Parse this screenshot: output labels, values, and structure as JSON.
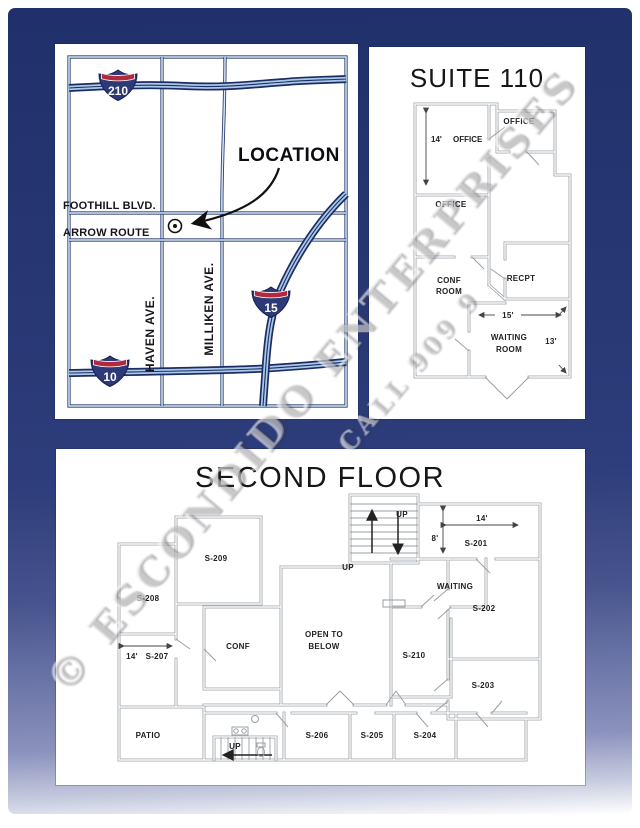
{
  "watermark": {
    "line1": "© ESCONDIDO ENTERPRISES",
    "line2": "CALL 909 9"
  },
  "map": {
    "location_label": "LOCATION",
    "streets": {
      "foothill": "FOOTHILL BLVD.",
      "arrow_route": "ARROW ROUTE",
      "haven": "HAVEN AVE.",
      "milliken": "MILLIKEN AVE."
    },
    "highways": {
      "i210": "210",
      "i15": "15",
      "i10": "10"
    }
  },
  "suite110": {
    "title": "SUITE 110",
    "labels": {
      "dim14": "14'",
      "office14": "OFFICE",
      "office_top": "OFFICE",
      "office_mid": "OFFICE",
      "conf1": "CONF",
      "conf2": "ROOM",
      "recpt": "RECPT",
      "dim15": "15'",
      "waiting1": "WAITING",
      "waiting2": "ROOM",
      "dim13": "13'"
    }
  },
  "second_floor": {
    "title": "SECOND FLOOR",
    "labels": {
      "up_top": "UP",
      "up_mid": "UP",
      "dim14": "14'",
      "dim8": "8'",
      "s201": "S-201",
      "waiting": "WAITING",
      "s202": "S-202",
      "s209": "S-209",
      "s208": "S-208",
      "conf": "CONF",
      "open1": "OPEN TO",
      "open2": "BELOW",
      "s210": "S-210",
      "s203": "S-203",
      "dim14b": "14'",
      "s207": "S-207",
      "patio": "PATIO",
      "up_bottom": "UP",
      "s206": "S-206",
      "s205": "S-205",
      "s204": "S-204"
    }
  },
  "colors": {
    "background_navy": "#2a3a74",
    "background_periwinkle": "#8b92bd",
    "panel_white": "#ffffff",
    "map_line_navy": "#1d2c62",
    "freeway_fill_blue": "#a9c9e9",
    "shield_red": "#b3283a",
    "shield_blue": "#2e3a78",
    "wall_gray": "#9aa0a6"
  }
}
